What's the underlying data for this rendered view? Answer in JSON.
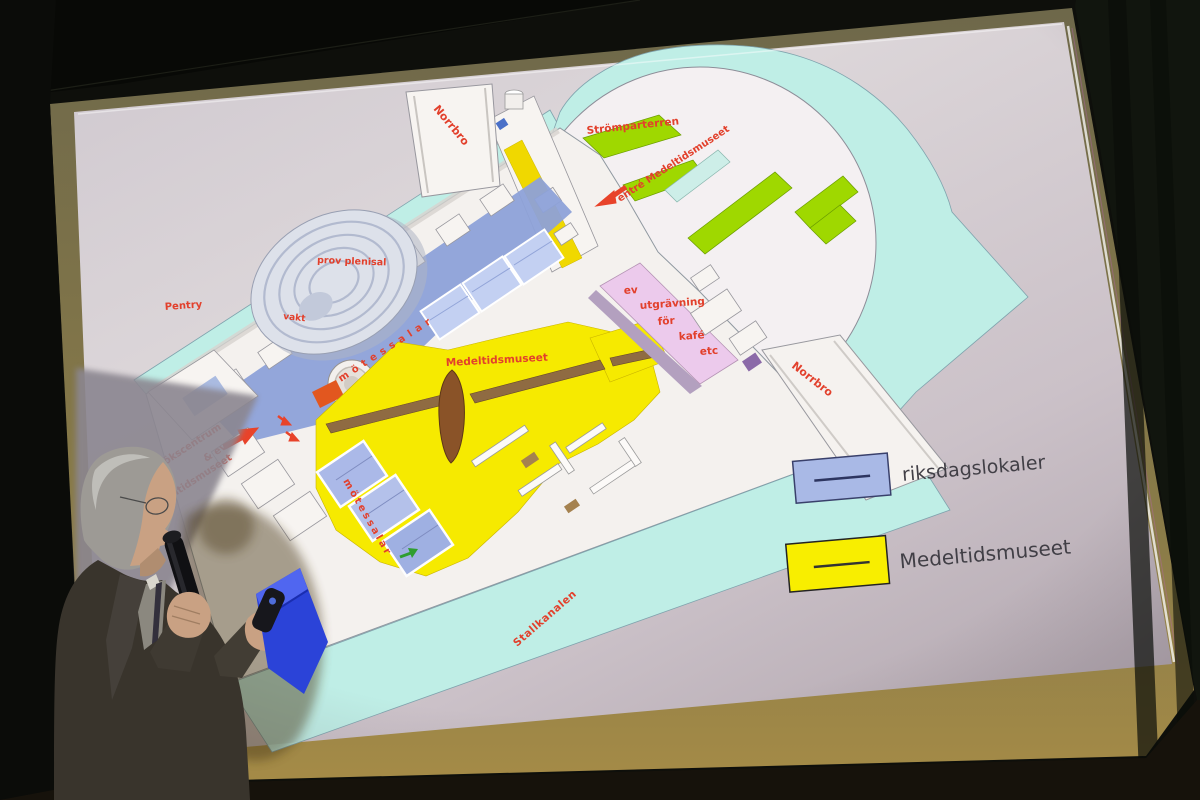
{
  "slide": {
    "plan_labels": {
      "norrbro_top": "Norrbro",
      "stromparterren": "Strömparterren",
      "entre": "entré  Medeltidsmuseet",
      "prov_plenisal": "prov plenisal",
      "vakt": "vakt",
      "pentry": "Pentry",
      "motessalar_upper": "mötessalar",
      "medeltidsmuseet": "Medeltidsmuseet",
      "utgravning": [
        "ev",
        "utgrävning",
        "för",
        "kafé",
        "etc"
      ],
      "norrbro_right": "Norrbro",
      "stallkanalen": "Stallkanalen",
      "motessalar_lower": "mötessalar",
      "besokscentrum": [
        "sökscentrum",
        "& ev",
        "eltidsmuseet"
      ]
    },
    "legend": [
      {
        "label": "riksdagslokaler",
        "color": "#a9b9e6"
      },
      {
        "label": "Medeltidsmuseet",
        "color": "#f8ee00"
      }
    ],
    "colors": {
      "label_red": "#e2402c",
      "water": "#bfeee6",
      "lawn_green": "#9fd800",
      "pool_cyan": "#cdeee8",
      "museum_yellow": "#f6ea00",
      "rooms_blue": "#8da1d8",
      "excavation_pink": "#eccaec",
      "background_gray": "#cdc4ca",
      "wall_brown": "#8f6b42",
      "boat_brown": "#8a5328",
      "folder_blue": "#2b43d8"
    }
  }
}
